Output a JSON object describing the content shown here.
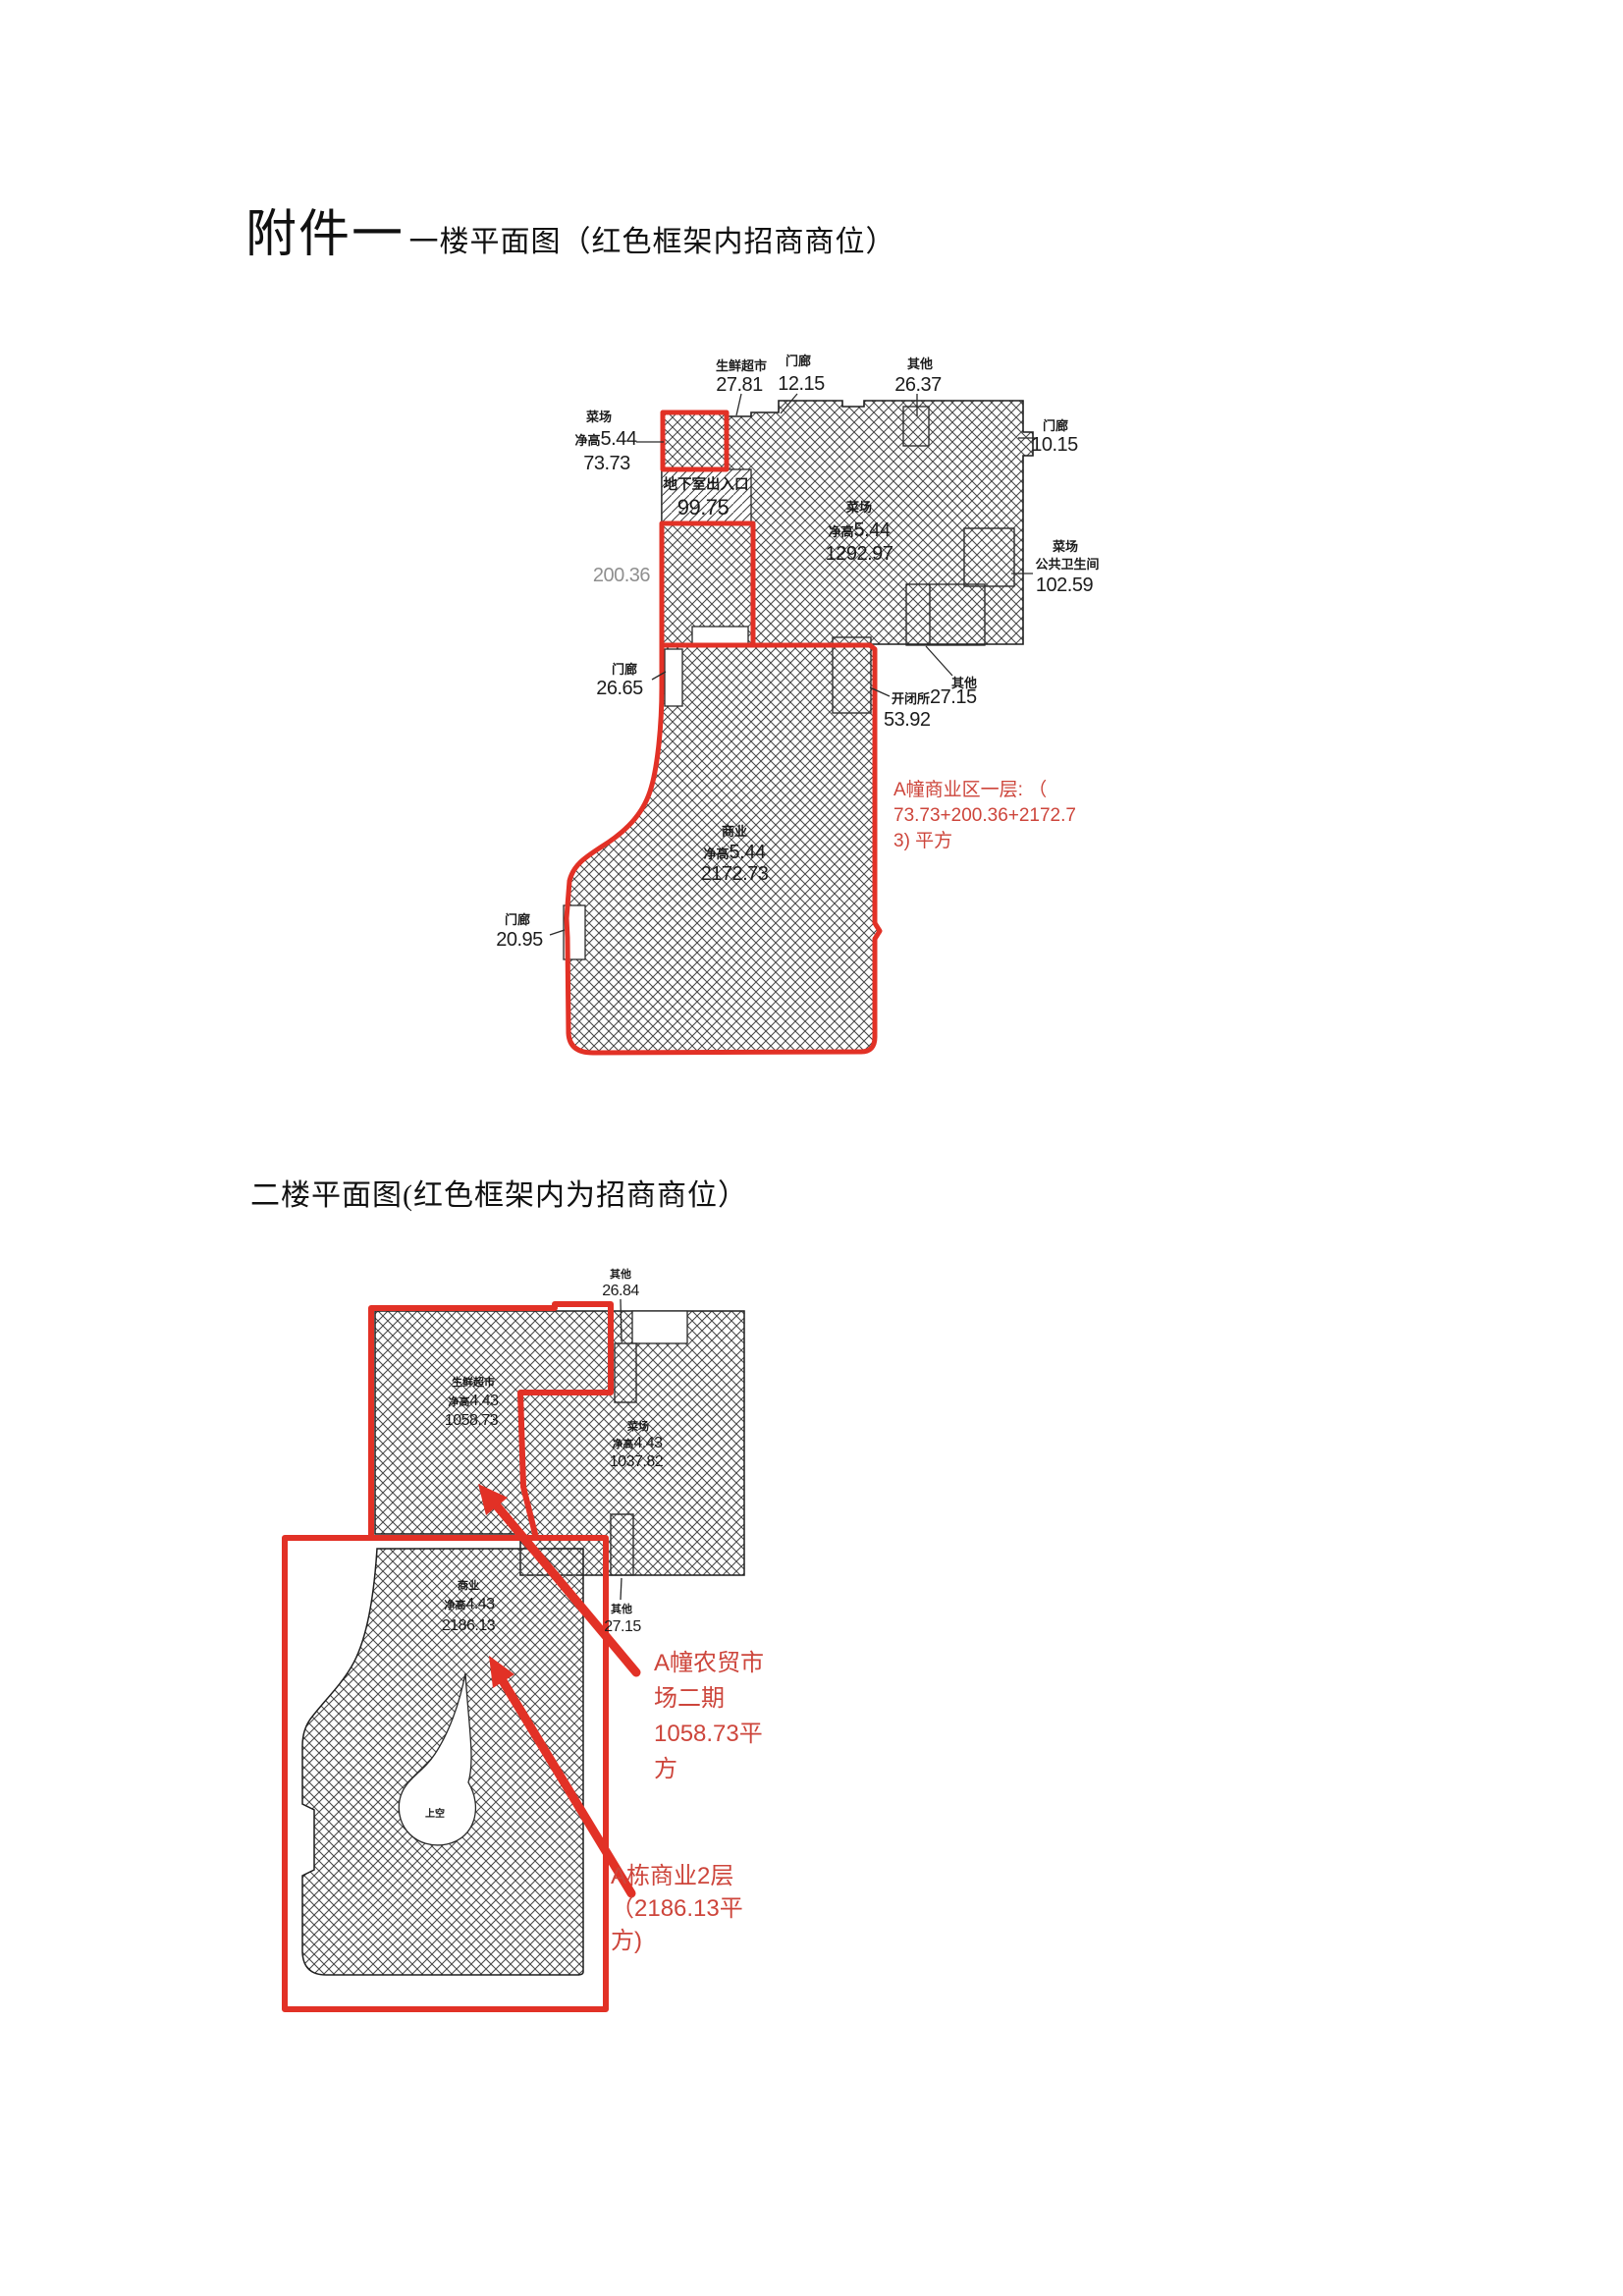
{
  "colors": {
    "red": "#e23126",
    "red_text": "#cd453b",
    "wall": "#1f1f1f",
    "hatch": "#474747",
    "gray_dim": "#8f8f8f"
  },
  "titles": {
    "attachment": "附件一",
    "floor1": "一楼平面图（红色框架内招商商位）",
    "floor2": "二楼平面图(红色框架内为招商商位）"
  },
  "floor1": {
    "fresh_market": {
      "name": "生鲜超市",
      "value": "27.81"
    },
    "porch_top": {
      "name": "门廊",
      "value": "12.15"
    },
    "other_top": {
      "name": "其他",
      "value": "26.37"
    },
    "porch_right": {
      "name": "门廊",
      "value": "10.15"
    },
    "market_left": {
      "name": "菜场",
      "height_label": "净高",
      "height_value": "5.44",
      "value": "73.73"
    },
    "basement": {
      "name": "地下室出入口",
      "value": "99.75"
    },
    "middle_area": {
      "value": "200.36"
    },
    "market_main": {
      "name": "菜场",
      "height_label": "净高",
      "height_value": "5.44",
      "value": "1292.97"
    },
    "wc": {
      "name": "菜场",
      "name2": "公共卫生间",
      "value": "102.59"
    },
    "porch_left": {
      "name": "门廊",
      "value": "26.65"
    },
    "other_bottom": {
      "name": "其他"
    },
    "switch_station": {
      "name": "开闭所",
      "value": "27.15",
      "value2": "53.92"
    },
    "commerce": {
      "name": "商业",
      "height_label": "净高",
      "height_value": "5.44",
      "value": "2172.73"
    },
    "porch_bottom": {
      "name": "门廊",
      "value": "20.95"
    },
    "note": {
      "line1": "A幢商业区一层:  （",
      "line2": "73.73+200.36+2172.7",
      "line3": "3) 平方"
    }
  },
  "floor2": {
    "other_top": {
      "name": "其他",
      "value": "26.84"
    },
    "fresh_market": {
      "name": "生鲜超市",
      "height_label": "净高",
      "height_value": "4.43",
      "value": "1058.73"
    },
    "market": {
      "name": "菜场",
      "height_label": "净高",
      "height_value": "4.43",
      "value": "1037.82"
    },
    "other_mid": {
      "name": "其他",
      "value": "27.15"
    },
    "commerce": {
      "name": "商业",
      "height_label": "净高",
      "height_value": "4.43",
      "value": "2186.13"
    },
    "void_label": "上空",
    "note1": {
      "line1": "A幢农贸市",
      "line2": "场二期",
      "line3": "1058.73平",
      "line4": "方"
    },
    "note2": {
      "line1": "A栋商业2层",
      "line2": "（2186.13平",
      "line3": "方)"
    }
  }
}
